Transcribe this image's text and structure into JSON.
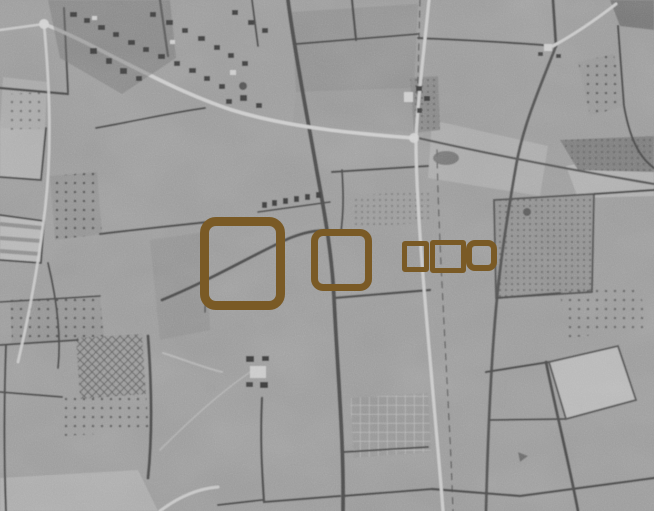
{
  "canvas": {
    "width": 654,
    "height": 511
  },
  "image": {
    "kind": "grayscale-aerial-photograph",
    "description": "Black-and-white aerial photograph of hedgerow-bounded farmland: a village along a curving road at top left, a vertical road right of centre, orchard dot-grids, a cross-hatched plot lower left, an allotment grid bottom centre, and lighter open fields at the edges",
    "base_color": "#9a9a9a",
    "hedgerow_color": "#4e4e4e",
    "road_color": "#cbcbcb",
    "building_color": "#424242"
  },
  "annotations": {
    "stroke_color": "#7a5a25",
    "count": 5,
    "boxes": [
      {
        "name": "annotation-box-large",
        "x": 200,
        "y": 217,
        "width": 85,
        "height": 93,
        "border": 9,
        "radius": 16
      },
      {
        "name": "annotation-box-medium",
        "x": 311,
        "y": 229,
        "width": 61,
        "height": 62,
        "border": 7,
        "radius": 12
      },
      {
        "name": "annotation-box-small-1",
        "x": 402,
        "y": 241,
        "width": 27,
        "height": 31,
        "border": 5,
        "radius": 3
      },
      {
        "name": "annotation-box-small-2",
        "x": 430,
        "y": 240,
        "width": 36,
        "height": 33,
        "border": 5,
        "radius": 3
      },
      {
        "name": "annotation-box-small-3",
        "x": 466,
        "y": 240,
        "width": 31,
        "height": 31,
        "border": 6,
        "radius": 9
      }
    ]
  }
}
